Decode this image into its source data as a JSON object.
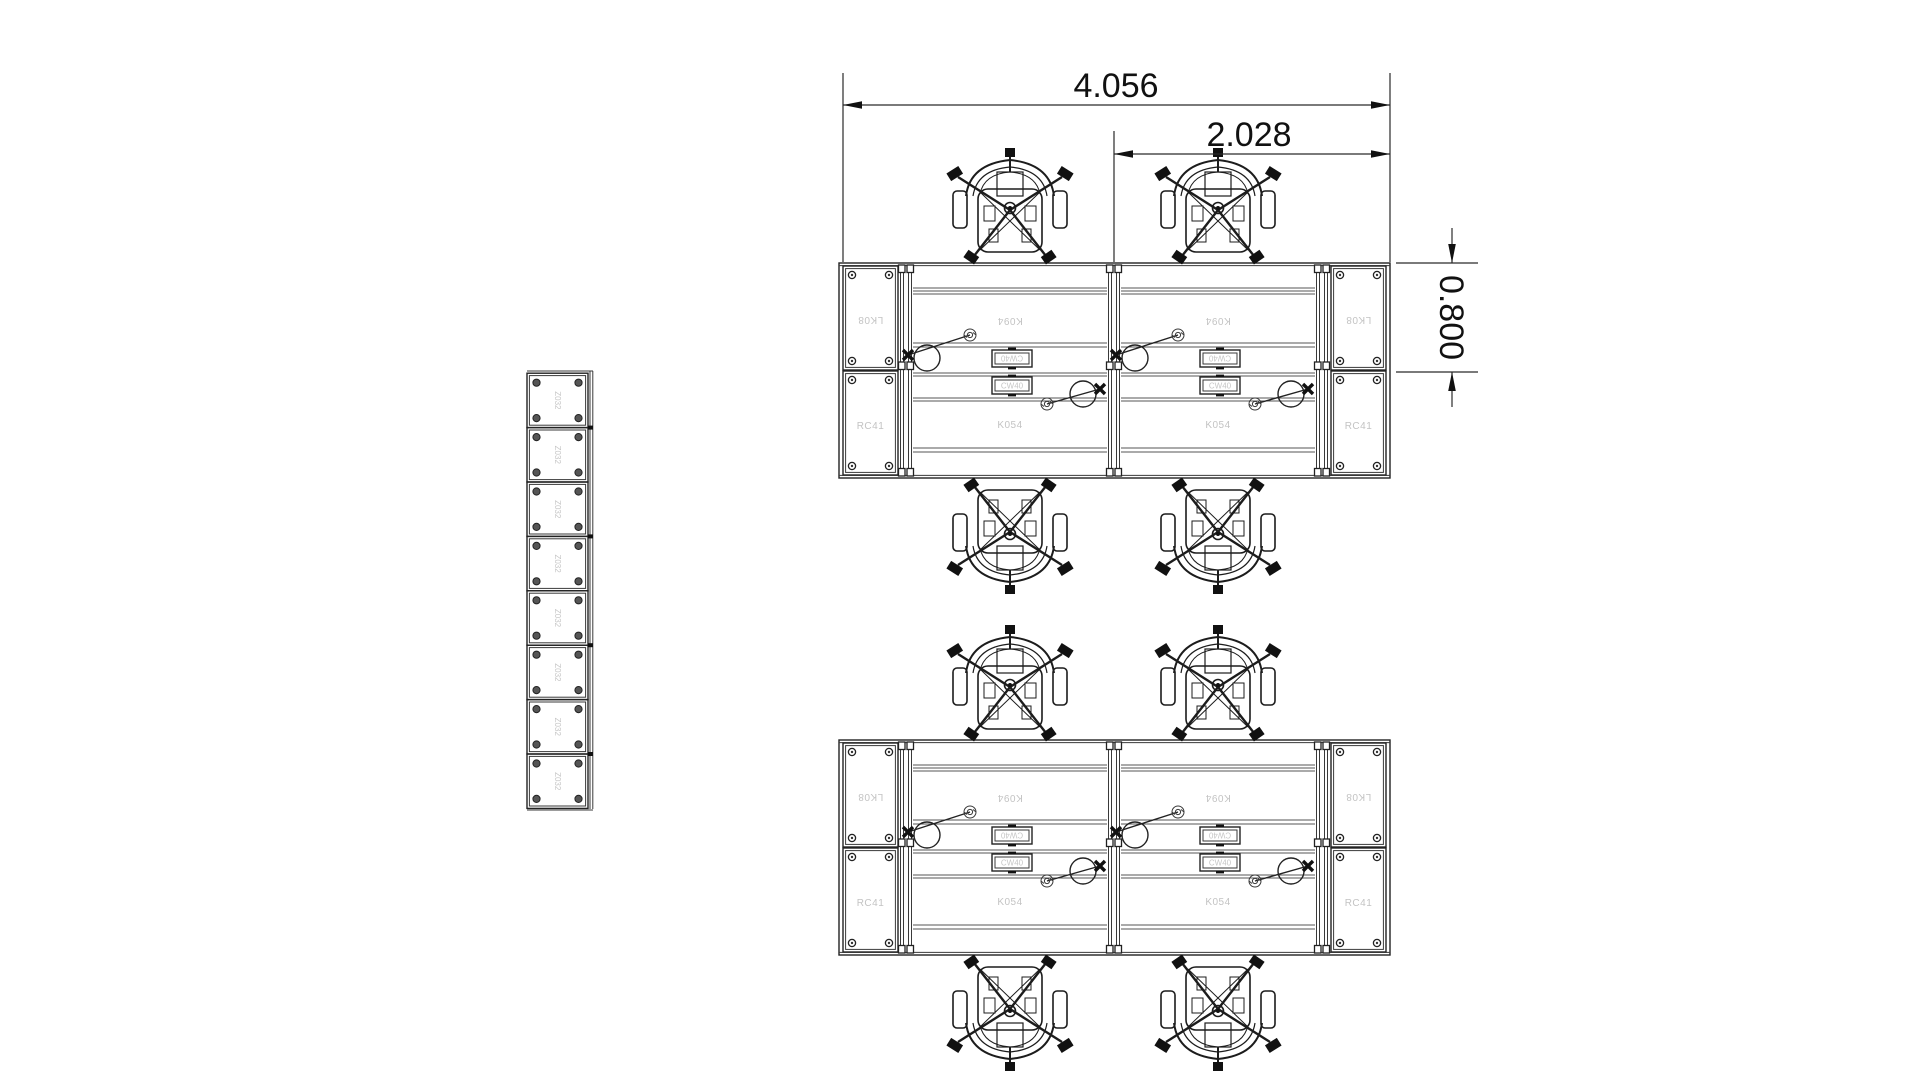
{
  "title": "Office workstation cluster floor plan",
  "dimensions": {
    "overall_width_m": "4.056",
    "half_width_m": "2.028",
    "desk_depth_m": "0.800"
  },
  "labels": {
    "desk_upper": "K094",
    "desk_lower": "K054",
    "side_cabinet_upper": "LK08",
    "side_cabinet_lower": "RC41",
    "cable_box": "CW40",
    "locker_unit": "Z032"
  },
  "colors": {
    "line": "#222222",
    "faint_label": "#c3c3c3",
    "background": "#ffffff"
  }
}
